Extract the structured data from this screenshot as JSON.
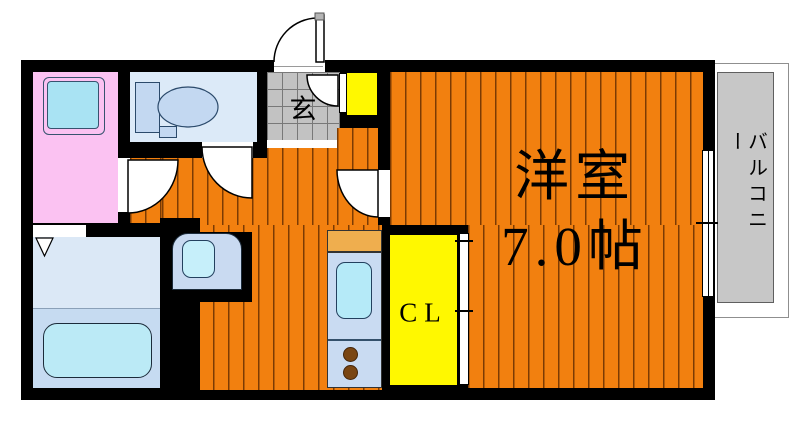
{
  "plan": {
    "labels": {
      "entrance": "玄",
      "main_room_name": "洋室",
      "main_room_size": "7.0帖",
      "closet": "CL",
      "balcony": "バルコニー"
    },
    "colors": {
      "floor_orange": "#F2800F",
      "wall_black": "#000000",
      "washroom_pink": "#FBC2F2",
      "closet_yellow": "#FFF800",
      "fixture_blue": "#C9DBF2",
      "water_cyan": "#B5EAF8",
      "entrance_tile_gray": "#C2C2C2",
      "balcony_gray": "#C7C7C7",
      "kitchen_counter_tan": "#EFAE4E",
      "stove_burner_brown": "#7A4613"
    }
  }
}
